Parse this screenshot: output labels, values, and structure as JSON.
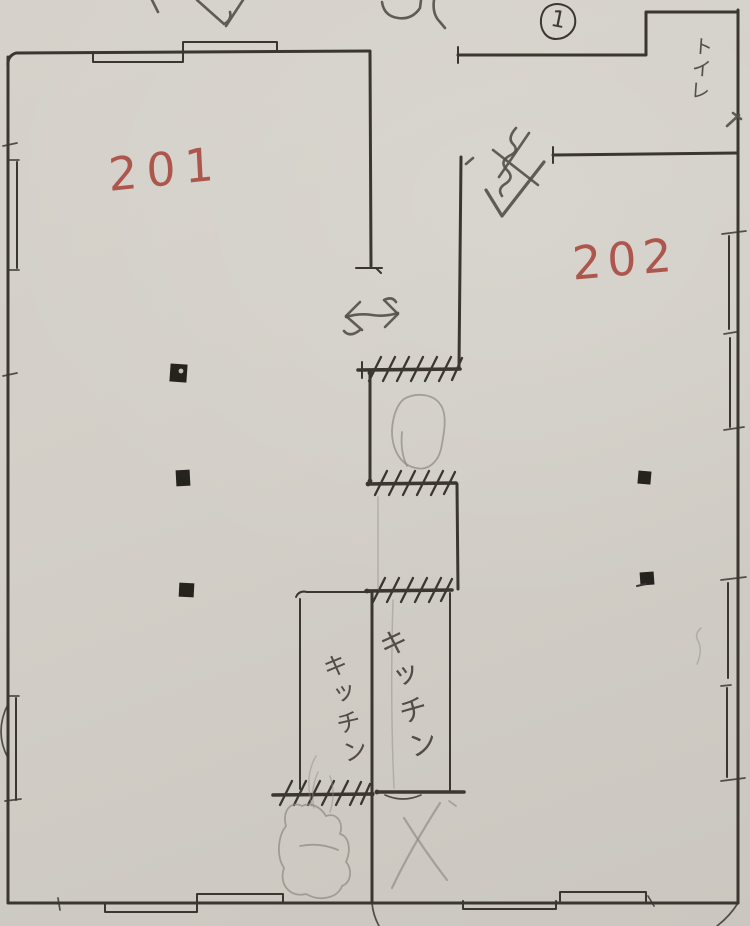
{
  "colors": {
    "paper": "#d3cfc8",
    "ink": "#3b3630",
    "pencil": "#8f897f",
    "pencil_dark": "#565049",
    "red": "#a8453c",
    "pillar": "#26221d"
  },
  "labels": {
    "room_left": "201",
    "room_right": "202",
    "kitchen_left": "キッチン",
    "kitchen_right": "キッチン",
    "toilet": "トイレ",
    "unit_number": "1"
  }
}
